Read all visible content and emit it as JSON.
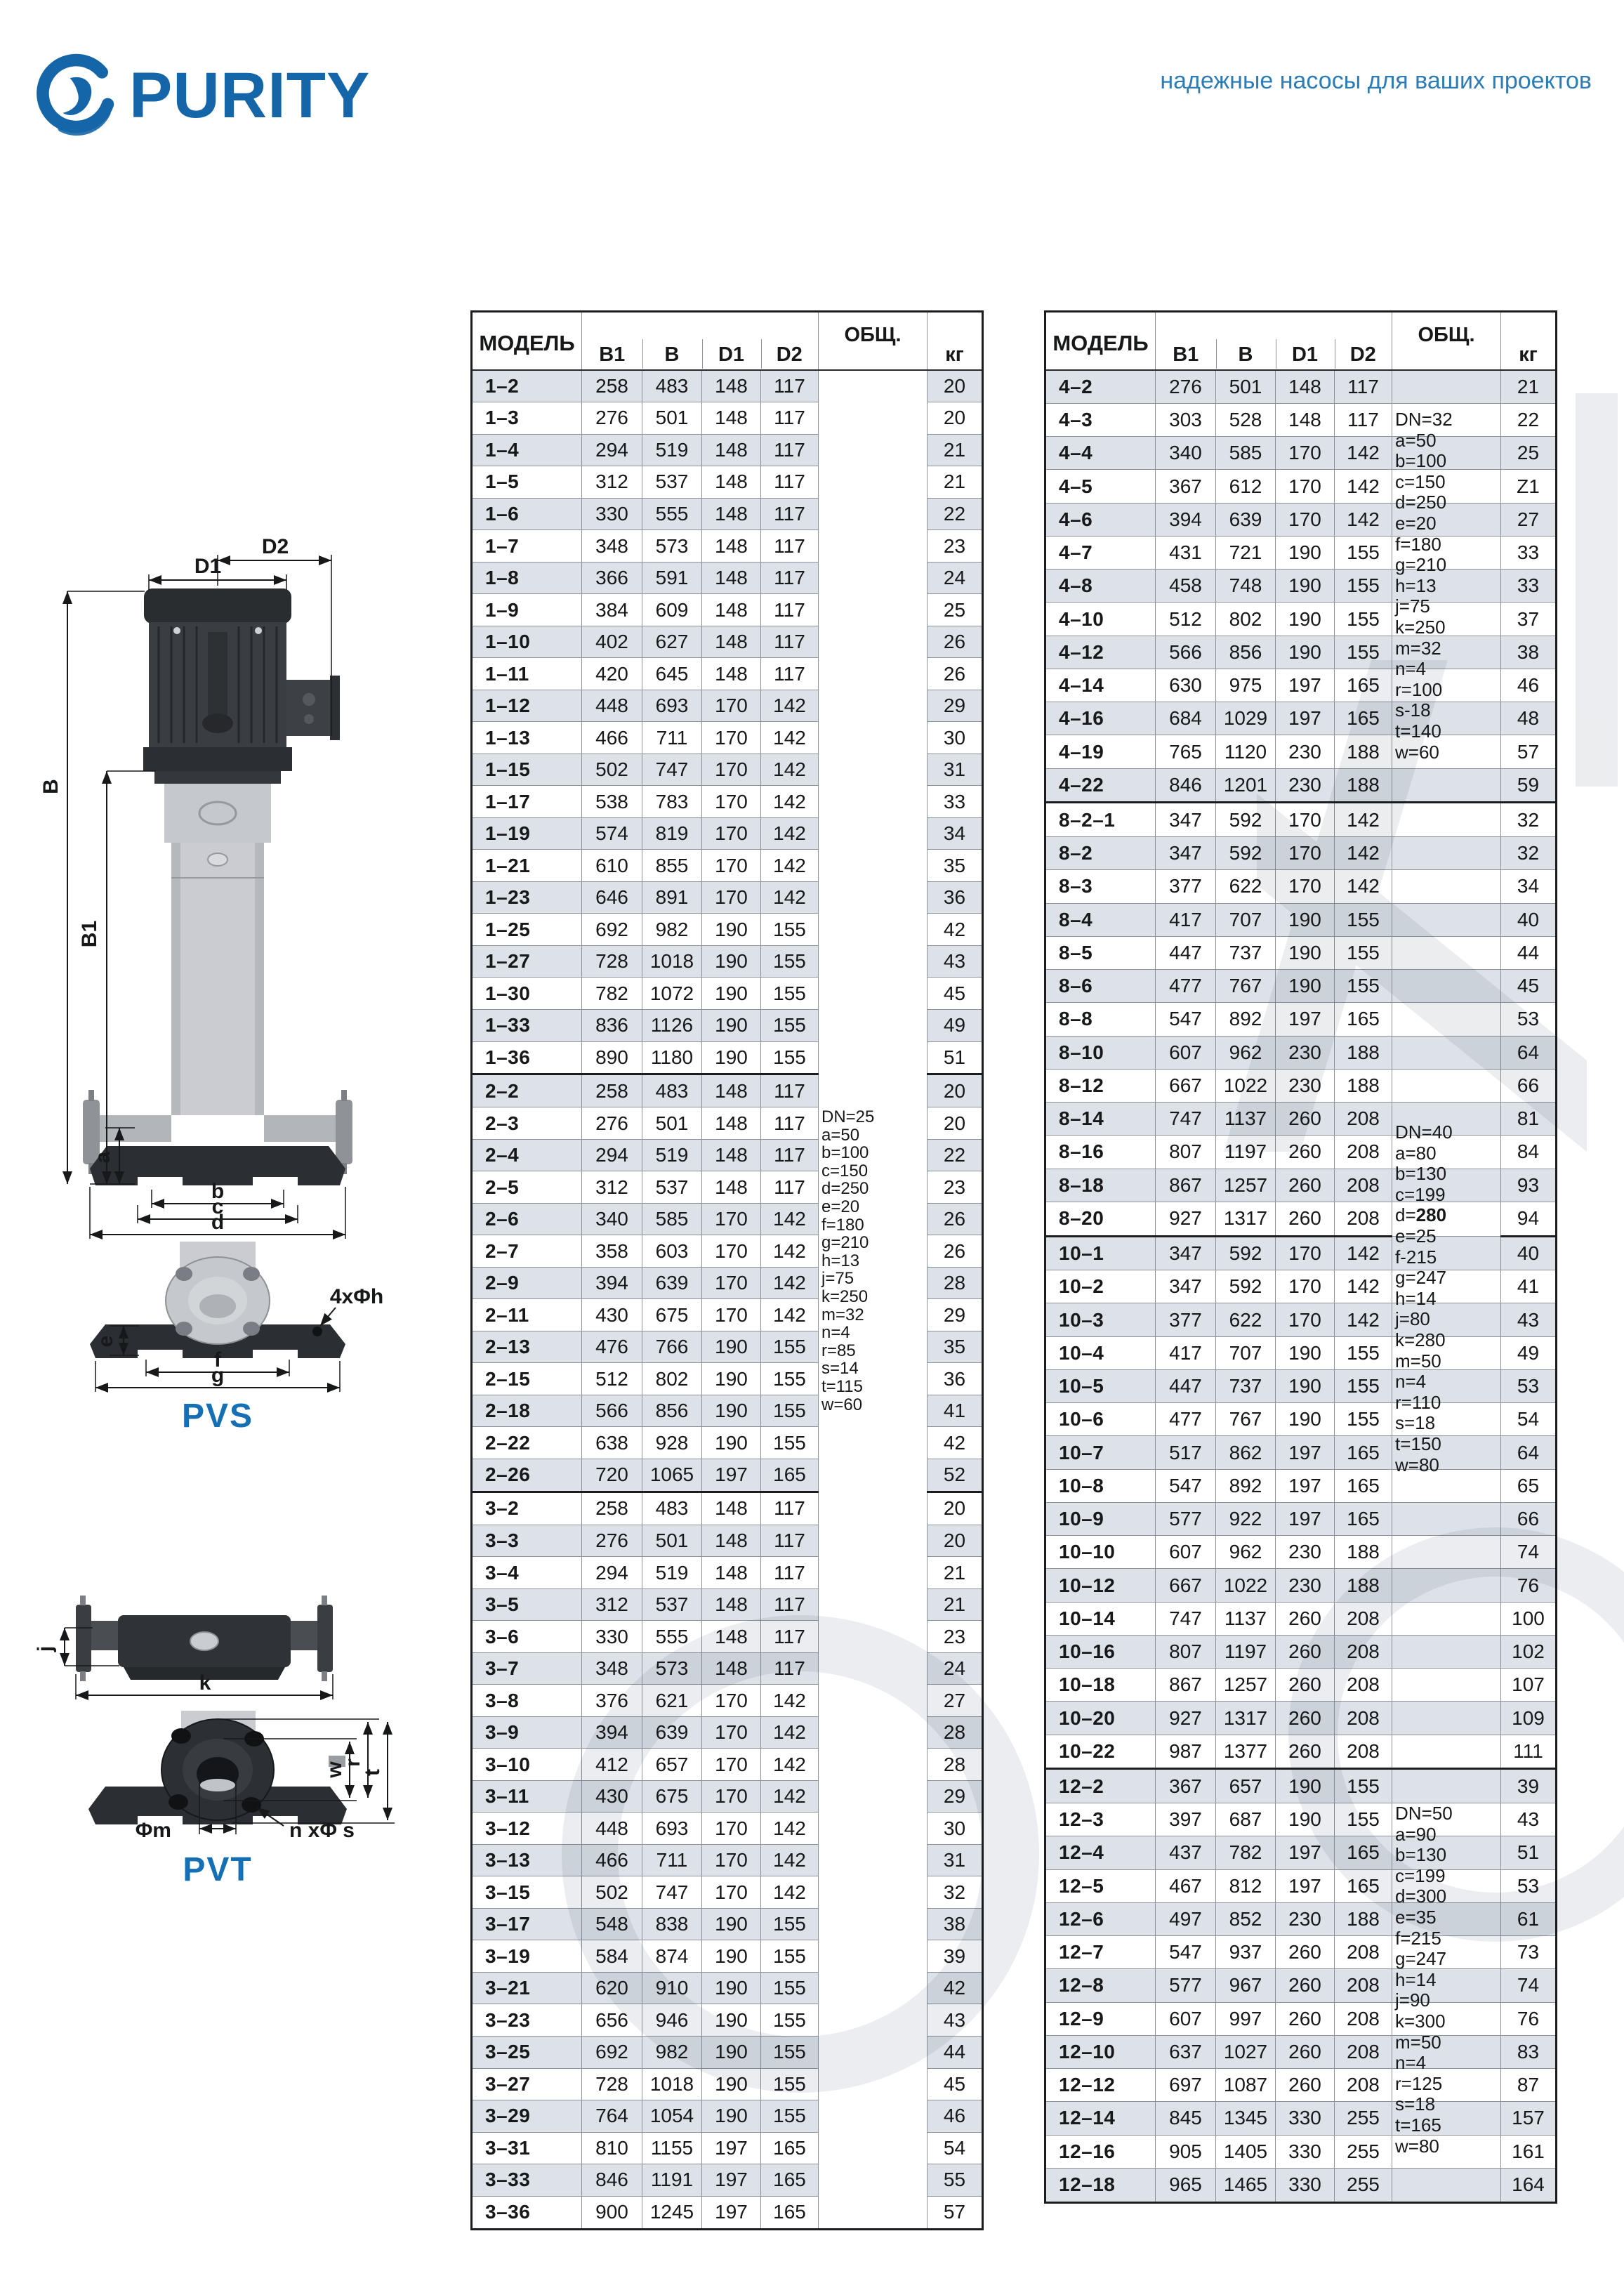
{
  "brand": {
    "logo_text": "PURITY",
    "slogan": "надежные насосы для ваших проектов"
  },
  "drawings": {
    "pvs_label": "PVS",
    "pvt_label": "PVT",
    "dims": {
      "D2": "D2",
      "D1": "D1",
      "B": "B",
      "B1": "B1",
      "a": "a",
      "b": "b",
      "c": "c",
      "d": "d",
      "bolt": "4xΦh",
      "e": "e",
      "f": "f",
      "g": "g",
      "j": "j",
      "k": "k",
      "w": "w",
      "r": "r",
      "t": "t",
      "phim": "Φm",
      "nphis": "n xΦ s"
    }
  },
  "table_header": {
    "model": "МОДЕЛЬ",
    "b1": "B1",
    "b": "B",
    "d1": "D1",
    "d2": "D2",
    "total": "ОБЩ.",
    "kg": "кг"
  },
  "left_table": {
    "notes": {
      "lines": [
        "DN=25",
        "a=50",
        "b=100",
        "c=150",
        "d=250",
        "e=20",
        "f=180",
        "g=210",
        "h=13",
        "j=75",
        "k=250",
        "m=32",
        "n=4",
        "r=85",
        "s=14",
        "t=115",
        "w=60"
      ]
    },
    "sections": [
      {
        "rows": [
          [
            "1–2",
            258,
            483,
            148,
            117,
            20
          ],
          [
            "1–3",
            276,
            501,
            148,
            117,
            20
          ],
          [
            "1–4",
            294,
            519,
            148,
            117,
            21
          ],
          [
            "1–5",
            312,
            537,
            148,
            117,
            21
          ],
          [
            "1–6",
            330,
            555,
            148,
            117,
            22
          ],
          [
            "1–7",
            348,
            573,
            148,
            117,
            23
          ],
          [
            "1–8",
            366,
            591,
            148,
            117,
            24
          ],
          [
            "1–9",
            384,
            609,
            148,
            117,
            25
          ],
          [
            "1–10",
            402,
            627,
            148,
            117,
            26
          ],
          [
            "1–11",
            420,
            645,
            148,
            117,
            26
          ],
          [
            "1–12",
            448,
            693,
            170,
            142,
            29
          ],
          [
            "1–13",
            466,
            711,
            170,
            142,
            30
          ],
          [
            "1–15",
            502,
            747,
            170,
            142,
            31
          ],
          [
            "1–17",
            538,
            783,
            170,
            142,
            33
          ],
          [
            "1–19",
            574,
            819,
            170,
            142,
            34
          ],
          [
            "1–21",
            610,
            855,
            170,
            142,
            35
          ],
          [
            "1–23",
            646,
            891,
            170,
            142,
            36
          ],
          [
            "1–25",
            692,
            982,
            190,
            155,
            42
          ],
          [
            "1–27",
            728,
            1018,
            190,
            155,
            43
          ],
          [
            "1–30",
            782,
            1072,
            190,
            155,
            45
          ],
          [
            "1–33",
            836,
            1126,
            190,
            155,
            49
          ],
          [
            "1–36",
            890,
            1180,
            190,
            155,
            51
          ]
        ]
      },
      {
        "rows": [
          [
            "2–2",
            258,
            483,
            148,
            117,
            20
          ],
          [
            "2–3",
            276,
            501,
            148,
            117,
            20
          ],
          [
            "2–4",
            294,
            519,
            148,
            117,
            22
          ],
          [
            "2–5",
            312,
            537,
            148,
            117,
            23
          ],
          [
            "2–6",
            340,
            585,
            170,
            142,
            26
          ],
          [
            "2–7",
            358,
            603,
            170,
            142,
            26
          ],
          [
            "2–9",
            394,
            639,
            170,
            142,
            28
          ],
          [
            "2–11",
            430,
            675,
            170,
            142,
            29
          ],
          [
            "2–13",
            476,
            766,
            190,
            155,
            35
          ],
          [
            "2–15",
            512,
            802,
            190,
            155,
            36
          ],
          [
            "2–18",
            566,
            856,
            190,
            155,
            41
          ],
          [
            "2–22",
            638,
            928,
            190,
            155,
            42
          ],
          [
            "2–26",
            720,
            1065,
            197,
            165,
            52
          ]
        ]
      },
      {
        "rows": [
          [
            "3–2",
            258,
            483,
            148,
            117,
            20
          ],
          [
            "3–3",
            276,
            501,
            148,
            117,
            20
          ],
          [
            "3–4",
            294,
            519,
            148,
            117,
            21
          ],
          [
            "3–5",
            312,
            537,
            148,
            117,
            21
          ],
          [
            "3–6",
            330,
            555,
            148,
            117,
            23
          ],
          [
            "3–7",
            348,
            573,
            148,
            117,
            24
          ],
          [
            "3–8",
            376,
            621,
            170,
            142,
            27
          ],
          [
            "3–9",
            394,
            639,
            170,
            142,
            28
          ],
          [
            "3–10",
            412,
            657,
            170,
            142,
            28
          ],
          [
            "3–11",
            430,
            675,
            170,
            142,
            29
          ],
          [
            "3–12",
            448,
            693,
            170,
            142,
            30
          ],
          [
            "3–13",
            466,
            711,
            170,
            142,
            31
          ],
          [
            "3–15",
            502,
            747,
            170,
            142,
            32
          ],
          [
            "3–17",
            548,
            838,
            190,
            155,
            38
          ],
          [
            "3–19",
            584,
            874,
            190,
            155,
            39
          ],
          [
            "3–21",
            620,
            910,
            190,
            155,
            42
          ],
          [
            "3–23",
            656,
            946,
            190,
            155,
            43
          ],
          [
            "3–25",
            692,
            982,
            190,
            155,
            44
          ],
          [
            "3–27",
            728,
            1018,
            190,
            155,
            45
          ],
          [
            "3–29",
            764,
            1054,
            190,
            155,
            46
          ],
          [
            "3–31",
            810,
            1155,
            197,
            165,
            54
          ],
          [
            "3–33",
            846,
            1191,
            197,
            165,
            55
          ],
          [
            "3–36",
            900,
            1245,
            197,
            165,
            57
          ]
        ]
      }
    ]
  },
  "right_table": {
    "notes_blocks": [
      {
        "lines": [
          "DN=32",
          "a=50",
          "b=100",
          "c=150",
          "d=250",
          "e=20",
          "f=180",
          "g=210",
          "h=13",
          "j=75",
          "k=250",
          "m=32",
          "n=4",
          "r=100",
          "s-18",
          "t=140",
          "w=60"
        ]
      },
      {
        "lines": [
          "DN=40",
          "a=80",
          "b=130",
          "c=199",
          "d=280",
          "e=25",
          "f-215",
          "g=247",
          "h=14",
          "j=80",
          "k=280",
          "m=50",
          "n=4",
          "r=110",
          "s=18",
          "t=150",
          "w=80"
        ],
        "bold_line": "d=280"
      },
      {
        "lines": [
          "DN=50",
          "a=90",
          "b=130",
          "c=199",
          "d=300",
          "e=35",
          "f=215",
          "g=247",
          "h=14",
          "j=90",
          "k=300",
          "m=50",
          "n=4",
          "r=125",
          "s=18",
          "t=165",
          "w=80"
        ]
      }
    ],
    "sections": [
      {
        "rows": [
          [
            "4–2",
            276,
            501,
            148,
            117,
            21
          ],
          [
            "4–3",
            303,
            528,
            148,
            117,
            22
          ],
          [
            "4–4",
            340,
            585,
            170,
            142,
            25
          ],
          [
            "4–5",
            367,
            612,
            170,
            142,
            "Z1"
          ],
          [
            "4–6",
            394,
            639,
            170,
            142,
            27
          ],
          [
            "4–7",
            431,
            721,
            190,
            155,
            33
          ],
          [
            "4–8",
            458,
            748,
            190,
            155,
            33
          ],
          [
            "4–10",
            512,
            802,
            190,
            155,
            37
          ],
          [
            "4–12",
            566,
            856,
            190,
            155,
            38
          ],
          [
            "4–14",
            630,
            975,
            197,
            165,
            46
          ],
          [
            "4–16",
            684,
            1029,
            197,
            165,
            48
          ],
          [
            "4–19",
            765,
            1120,
            230,
            188,
            57
          ],
          [
            "4–22",
            846,
            1201,
            230,
            188,
            59
          ]
        ],
        "thick_notes": true
      },
      {
        "rows": [
          [
            "8–2–1",
            347,
            592,
            170,
            142,
            32
          ],
          [
            "8–2",
            347,
            592,
            170,
            142,
            32
          ],
          [
            "8–3",
            377,
            622,
            170,
            142,
            34
          ],
          [
            "8–4",
            417,
            707,
            190,
            155,
            40
          ],
          [
            "8–5",
            447,
            737,
            190,
            155,
            44
          ],
          [
            "8–6",
            477,
            767,
            190,
            155,
            45
          ],
          [
            "8–8",
            547,
            892,
            197,
            165,
            53
          ],
          [
            "8–10",
            607,
            962,
            230,
            188,
            64
          ],
          [
            "8–12",
            667,
            1022,
            230,
            188,
            66
          ],
          [
            "8–14",
            747,
            1137,
            260,
            208,
            81
          ],
          [
            "8–16",
            807,
            1197,
            260,
            208,
            84
          ],
          [
            "8–18",
            867,
            1257,
            260,
            208,
            93
          ],
          [
            "8–20",
            927,
            1317,
            260,
            208,
            94
          ]
        ],
        "thick_notes": true
      },
      {
        "rows": [
          [
            "10–1",
            347,
            592,
            170,
            142,
            40
          ],
          [
            "10–2",
            347,
            592,
            170,
            142,
            41
          ],
          [
            "10–3",
            377,
            622,
            170,
            142,
            43
          ],
          [
            "10–4",
            417,
            707,
            190,
            155,
            49
          ],
          [
            "10–5",
            447,
            737,
            190,
            155,
            53
          ],
          [
            "10–6",
            477,
            767,
            190,
            155,
            54
          ],
          [
            "10–7",
            517,
            862,
            197,
            165,
            64
          ],
          [
            "10–8",
            547,
            892,
            197,
            165,
            65
          ],
          [
            "10–9",
            577,
            922,
            197,
            165,
            66
          ],
          [
            "10–10",
            607,
            962,
            230,
            188,
            74
          ],
          [
            "10–12",
            667,
            1022,
            230,
            188,
            76
          ],
          [
            "10–14",
            747,
            1137,
            260,
            208,
            100
          ],
          [
            "10–16",
            807,
            1197,
            260,
            208,
            102
          ],
          [
            "10–18",
            867,
            1257,
            260,
            208,
            107
          ],
          [
            "10–20",
            927,
            1317,
            260,
            208,
            109
          ],
          [
            "10–22",
            987,
            1377,
            260,
            208,
            111
          ]
        ],
        "thick_notes": false
      },
      {
        "rows": [
          [
            "12–2",
            367,
            657,
            190,
            155,
            39
          ],
          [
            "12–3",
            397,
            687,
            190,
            155,
            43
          ],
          [
            "12–4",
            437,
            782,
            197,
            165,
            51
          ],
          [
            "12–5",
            467,
            812,
            197,
            165,
            53
          ],
          [
            "12–6",
            497,
            852,
            230,
            188,
            61
          ],
          [
            "12–7",
            547,
            937,
            260,
            208,
            73
          ],
          [
            "12–8",
            577,
            967,
            260,
            208,
            74
          ],
          [
            "12–9",
            607,
            997,
            260,
            208,
            76
          ],
          [
            "12–10",
            637,
            1027,
            260,
            208,
            83
          ],
          [
            "12–12",
            697,
            1087,
            260,
            208,
            87
          ],
          [
            "12–14",
            845,
            1345,
            330,
            255,
            157
          ],
          [
            "12–16",
            905,
            1405,
            330,
            255,
            161
          ],
          [
            "12–18",
            965,
            1465,
            330,
            255,
            164
          ]
        ],
        "thick_notes": true
      }
    ]
  }
}
